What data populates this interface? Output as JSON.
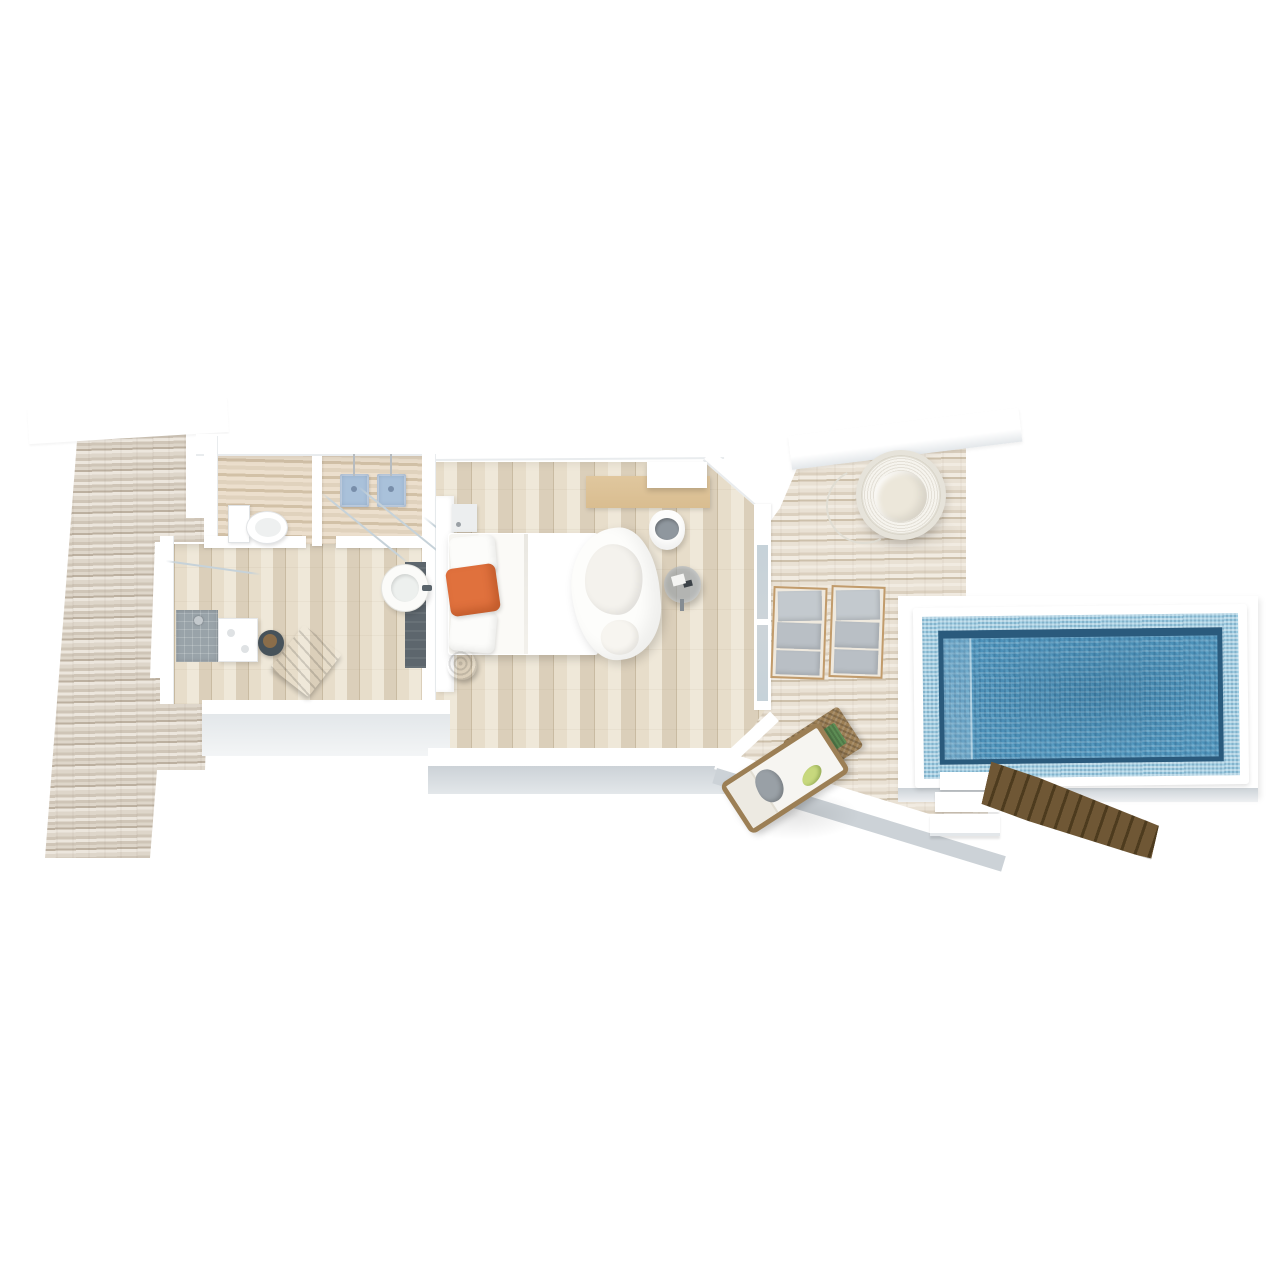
{
  "scene": {
    "title": "3D isometric floor plan of a pool villa with private deck",
    "width_px": 1280,
    "height_px": 1280
  },
  "colors": {
    "background": "#ffffff",
    "wall_white": "#ffffff",
    "wall_edge": "#e9ecee",
    "wall_face": "#e3e7ea",
    "wall_face_dark": "#ccd2d7",
    "deck_a": "#ded6ca",
    "deck_b": "#cfc5b7",
    "deck_c": "#bcb0a0",
    "deck_d": "#ece6dd",
    "deck2_a": "#e9e1d4",
    "deck2_b": "#dbd0bf",
    "deck2_c": "#f1ebe1",
    "deck2_d": "#cdc0ab",
    "floor_a": "#e7ddca",
    "floor_b": "#dbcfba",
    "floor_c": "#efe8d9",
    "floor_gap": "#c9bba2",
    "bath_a": "#e0d2bd",
    "bath_b": "#d2c1a7",
    "bath_c": "#ecdfcd",
    "pool_water": "#4d92ba",
    "pool_border_light": "#9ccbe1",
    "pool_wall_dark": "#2a5a7c",
    "pool_rim": "#ffffff",
    "stairs_wood": "#6f5735",
    "stairs_wood_dark": "#4d3b1e",
    "bench_wood": "#6e5434",
    "bench_wood_light": "#8a6b45",
    "orange": "#e0713d",
    "lounger_cushion": "#b9bfc5",
    "lounger_frame": "#c19b6b",
    "wicker": "#9c7f55",
    "green_pillow": "#c7d87d",
    "green_tray": "#5e8e55",
    "towel_gray": "#99a0a6",
    "basin_blue": "#a9c1da",
    "shower_gray": "#99a3a9",
    "dark_panel": "#5d666d",
    "stool_dark": "#46525a",
    "glass": "#c6d2d9",
    "desk_wood": "#d9bd90",
    "furn_white": "#fcfcfa",
    "cushion_gray": "#8f979e"
  },
  "zones": {
    "left_deck": "Weathered timber sun deck",
    "walkway": "Entry walkway",
    "bathroom": "Bathroom",
    "wc": "WC",
    "vanity": "Twin wall basins",
    "shower_room": "Shower room",
    "dressing_hall": "Dressing hall",
    "bedroom": "Bedroom",
    "pool_deck": "Pool deck",
    "pool_platform": "Pool surround",
    "pool": "Private pool",
    "sea_stairs": "Timber access steps"
  },
  "furniture": {
    "toilet": "Toilet",
    "basin_left": "Wall basin left",
    "basin_right": "Wall basin right",
    "glass_partition": "Glass partition",
    "washbasin_round": "Freestanding round washbasin",
    "bath_mat_panel": "Dark timber bath panel",
    "shower": "Walk-in shower",
    "bath_counter": "Bath counter",
    "wood_bench": "Teak bench",
    "dark_stool": "Vanity stool",
    "headboard": "Headboard",
    "nightstand": "Nightstand",
    "bed": "King bed with orange accent pillow",
    "pillow_orange": "Orange accent pillow",
    "bed_stool": "Round timber stool",
    "chaise": "Curved chaise lounge",
    "desk": "Writing desk",
    "shelf": "Wall shelf",
    "desk_chair": "Desk chair",
    "side_table": "Acrylic side table",
    "door_glass": "Sliding glass door",
    "egg_chair": "Hanging nest chair",
    "lounger": "Sun lounger pair",
    "daybed": "Rattan daybed",
    "coffee_table": "Rattan coffee table",
    "pool_steps": "Pool surround steps",
    "stairs": "Sea access stairs"
  }
}
